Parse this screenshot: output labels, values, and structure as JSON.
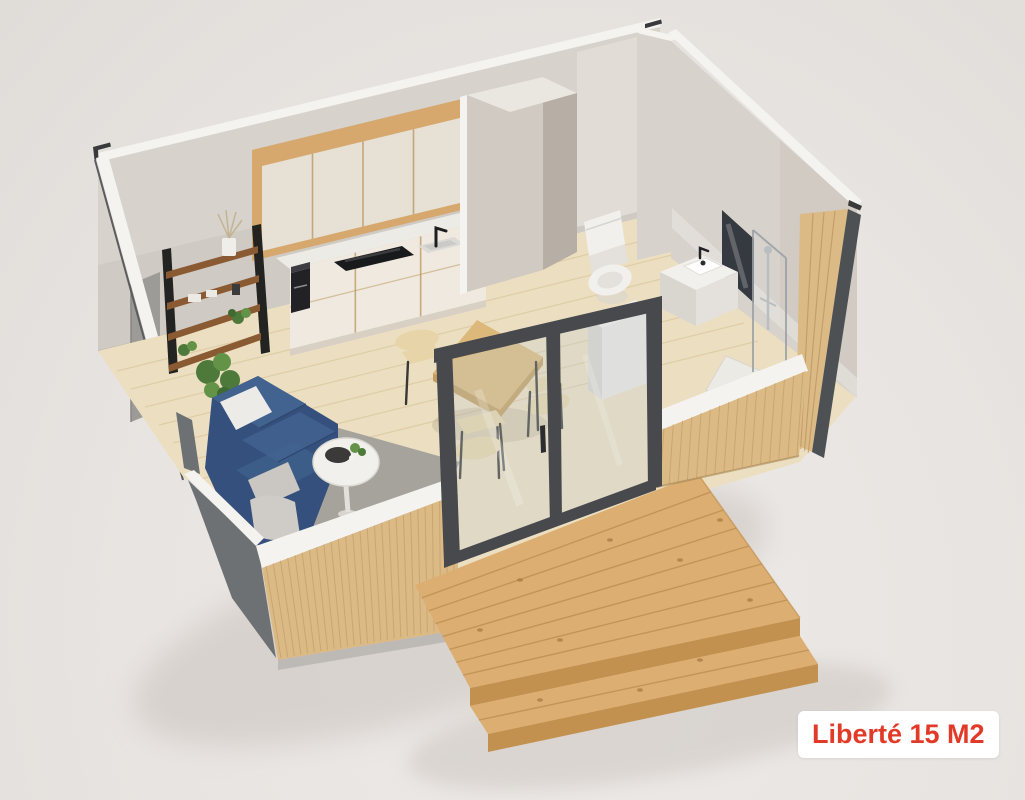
{
  "badge": {
    "text": "Liberté 15 M2"
  },
  "palette": {
    "background": "#e8e4e1",
    "bg_light": "#edeae7",
    "bg_edge": "#e0dcd8",
    "shadow": "#c9c3bd",
    "wall": "#d7d2cb",
    "wall_light": "#e1dcd5",
    "wall_top": "#f5f3f0",
    "column": "#d0cac2",
    "column_side": "#b7afa5",
    "column_top": "#eae6e0",
    "wood_frame": "#d6a86d",
    "cabinet": "#e6e0d5",
    "cabinet_gap": "#bb9a63",
    "counter": "#edebe6",
    "cabinet_base": "#efe9df",
    "toe": "#d8d0c3",
    "cooktop": "#191a1c",
    "sink": "#dcdad6",
    "sink_well": "#cccac6",
    "black": "#222226",
    "shelf_rail": "#232321",
    "shelf_wood": "#8a5a33",
    "plant": "#4d7a3a",
    "plant_light": "#639347",
    "rug": "#a6a29c",
    "sofa": "#35507c",
    "sofa_light": "#42628f",
    "sofa_dark": "#2a4269",
    "pillow": "#edebe7",
    "throw": "#cac7c2",
    "table_wood": "#dcb97b",
    "table_side": "#c39c5e",
    "chair": "#e7d4a8",
    "leg": "#3a3835",
    "fixture": "#f2f0ec",
    "fixture_shade": "#e4e1dc",
    "fixture_side": "#d9d5cf",
    "mirror": "#343a40",
    "glassline": "#9aa0a5",
    "floor": "#ecdfc1",
    "floor_line": "#d9c49c",
    "slat": "#dcba85",
    "slat_line": "#b58d55",
    "dark_base": "#6e7173",
    "deck": "#dcae72",
    "deck_shade": "#c2914f",
    "deck_line": "#b98c4e",
    "frame": "#47494d",
    "glass": "rgba(195,204,210,0.30)",
    "badge_bg": "#ffffff",
    "badge_text": "#e23a28"
  }
}
